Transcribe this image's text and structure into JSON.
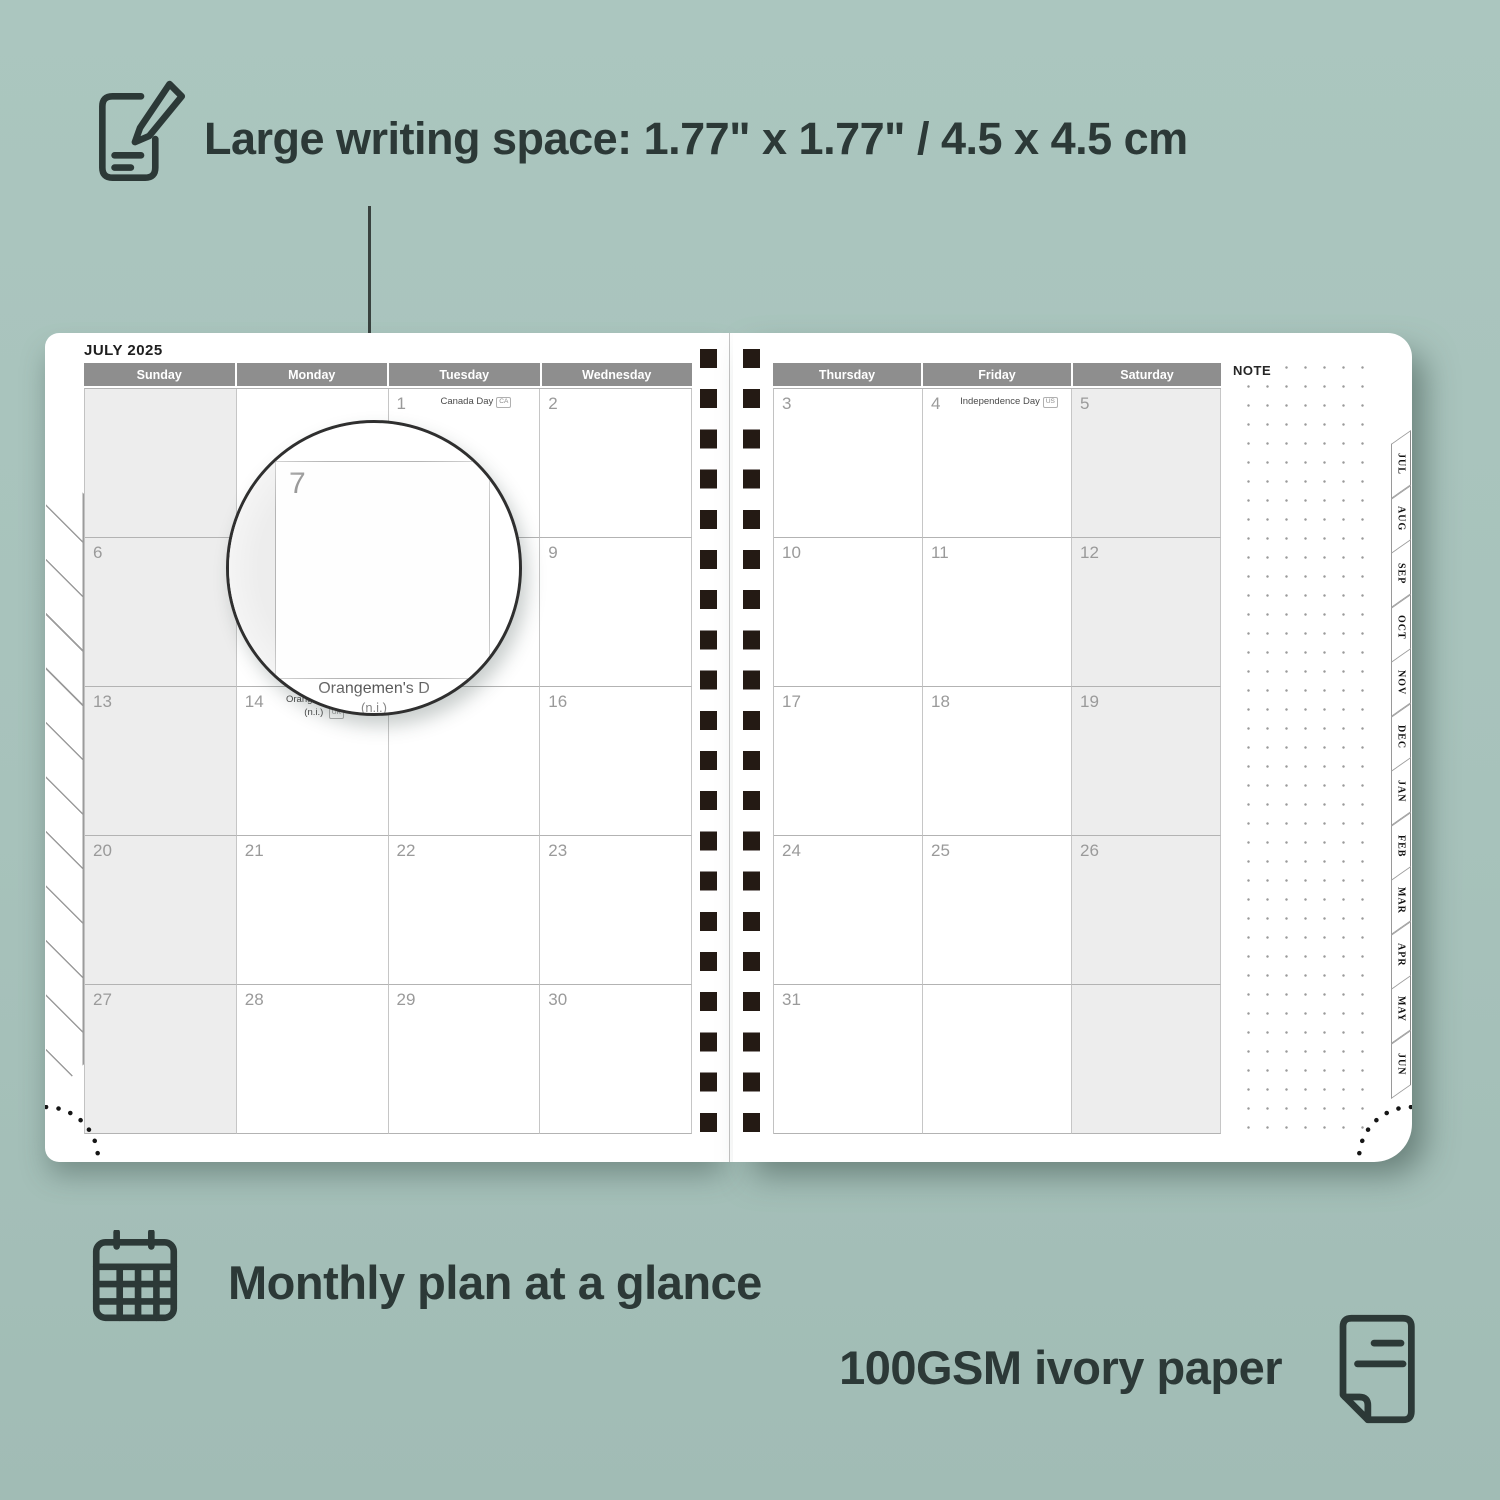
{
  "annotations": {
    "top": "Large writing space: 1.77\" x 1.77\" / 4.5 x 4.5 cm",
    "bottom_left": "Monthly plan at a glance",
    "bottom_right": "100GSM ivory paper"
  },
  "colors": {
    "background": "#a7c2bb",
    "ink": "#2c3937",
    "header_bg": "#8e8e8e",
    "weekend_bg": "#ededed",
    "spiral": "#241a14",
    "day_number": "#9a9a9a"
  },
  "planner": {
    "month_title": "JULY 2025",
    "note_label": "NOTE",
    "left_headers": [
      "Sunday",
      "Monday",
      "Tuesday",
      "Wednesday"
    ],
    "right_headers": [
      "Thursday",
      "Friday",
      "Saturday"
    ],
    "left_weeks": [
      [
        {
          "day": ""
        },
        {
          "day": ""
        },
        {
          "day": "1",
          "holiday": "Canada Day",
          "badge": "CA"
        },
        {
          "day": "2"
        }
      ],
      [
        {
          "day": "6"
        },
        {
          "day": "7"
        },
        {
          "day": "8"
        },
        {
          "day": "9"
        }
      ],
      [
        {
          "day": "13"
        },
        {
          "day": "14",
          "holiday": "Orangemen's Day",
          "holiday2": "(n.i.)",
          "badge": "UK"
        },
        {
          "day": "15"
        },
        {
          "day": "16"
        }
      ],
      [
        {
          "day": "20"
        },
        {
          "day": "21"
        },
        {
          "day": "22"
        },
        {
          "day": "23"
        }
      ],
      [
        {
          "day": "27"
        },
        {
          "day": "28"
        },
        {
          "day": "29"
        },
        {
          "day": "30"
        }
      ]
    ],
    "right_weeks": [
      [
        {
          "day": "3"
        },
        {
          "day": "4",
          "holiday": "Independence Day",
          "badge": "US"
        },
        {
          "day": "5"
        }
      ],
      [
        {
          "day": "10"
        },
        {
          "day": "11"
        },
        {
          "day": "12"
        }
      ],
      [
        {
          "day": "17"
        },
        {
          "day": "18"
        },
        {
          "day": "19"
        }
      ],
      [
        {
          "day": "24"
        },
        {
          "day": "25"
        },
        {
          "day": "26"
        }
      ],
      [
        {
          "day": "31"
        },
        {
          "day": ""
        },
        {
          "day": ""
        }
      ]
    ],
    "tabs": [
      "JUL",
      "AUG",
      "SEP",
      "OCT",
      "NOV",
      "DEC",
      "JAN",
      "FEB",
      "MAR",
      "APR",
      "MAY",
      "JUN"
    ]
  },
  "magnifier": {
    "day": "7",
    "overflow_text": "Orangemen's D",
    "overflow_text2": "(n.i.)"
  }
}
